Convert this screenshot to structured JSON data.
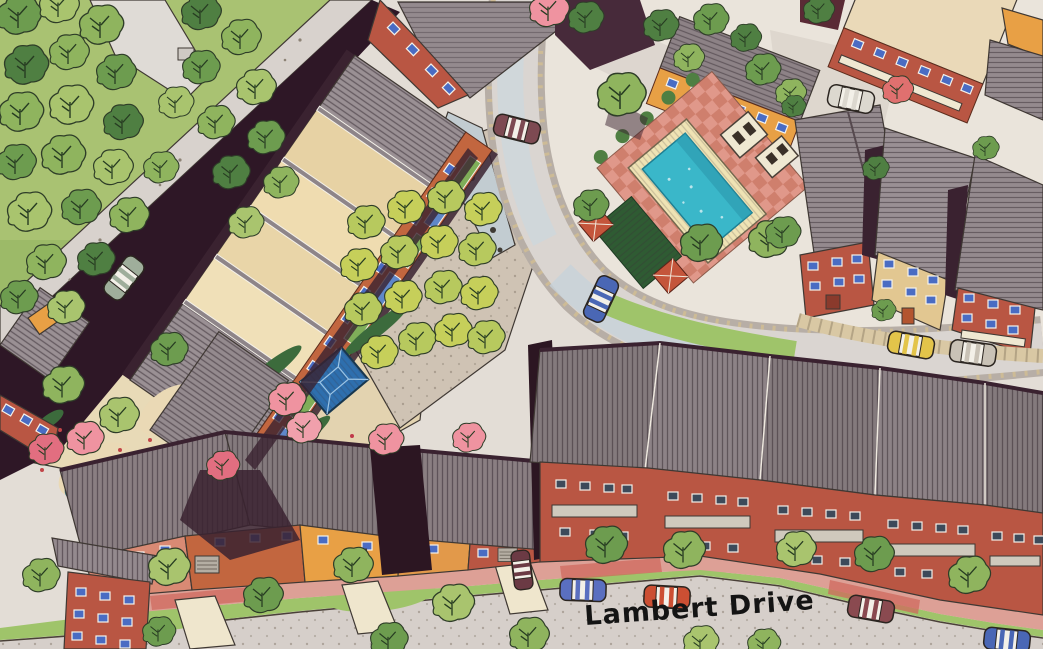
{
  "map": {
    "type": "illustrated-aerial-site-plan",
    "street_label": "Lambert Drive",
    "palette": {
      "paper": "#e3ddd6",
      "street_light": "#dad5d1",
      "street_blue_tint": "#c7d2da",
      "shaded_lane": "#2e1726",
      "roof_gray": "#948a8e",
      "roof_dark_townhouse": "#847a7d",
      "roof_tan_panels": "#ecd9ae",
      "roof_cream": "#ead9b8",
      "brick_facade": "#b95643",
      "orange_facade": "#e8a045",
      "tan_facade": "#e2c791",
      "window_blue": "#4a6cc3",
      "window_dark": "#3d4a5a",
      "pool_teal": "#3ab7c9",
      "pool_coping_cream": "#efe3b4",
      "plaza_brick_pink": "#e0988a",
      "sidewalk_pink": "#dda096",
      "path_red": "#cf6a5e",
      "grass": "#9fc46a",
      "woodland_ground": "#a9c272",
      "tree_green": "#8fb45e",
      "tree_dark_green": "#4f7f42",
      "tree_yellow_green": "#c6cf5a",
      "tree_pink": "#ef93a0",
      "hedge_dark": "#2f5b33",
      "gazebo_blue": "#2e6fae",
      "pond_blue": "#53aec7",
      "curb_stone": "#d9c8a4",
      "label_ink": "#141414"
    },
    "features": [
      {
        "name": "woodland",
        "type": "tree-grove",
        "location": "northwest"
      },
      {
        "name": "shaded-lane",
        "type": "road",
        "location": "northwest diagonal"
      },
      {
        "name": "long-building-tan-roof-panels",
        "type": "building",
        "location": "center-west"
      },
      {
        "name": "orchard-tree-rows",
        "type": "planting",
        "location": "center"
      },
      {
        "name": "central-courtyard-garden",
        "type": "garden",
        "location": "center"
      },
      {
        "name": "blue-roof-gazebo",
        "type": "pavilion",
        "location": "central courtyard"
      },
      {
        "name": "west-courtyard-garden-with-pond",
        "type": "garden",
        "location": "west"
      },
      {
        "name": "swimming-pool",
        "type": "pool",
        "location": "northeast plaza"
      },
      {
        "name": "pool-brick-plaza",
        "type": "paving",
        "location": "northeast"
      },
      {
        "name": "pergola-trellis",
        "type": "structure",
        "location": "west of pool"
      },
      {
        "name": "pool-side-pavilions",
        "type": "structure",
        "location": "east of pool"
      },
      {
        "name": "loop-road",
        "type": "road",
        "location": "around pool plaza"
      },
      {
        "name": "townhouse-row-sawtooth",
        "type": "housing-row",
        "location": "center-south"
      },
      {
        "name": "south-house-row",
        "type": "housing-row",
        "location": "southwest"
      },
      {
        "name": "east-condo-buildings",
        "type": "housing",
        "location": "east"
      },
      {
        "name": "north-buildings",
        "type": "buildings",
        "location": "north"
      },
      {
        "name": "lambert-drive",
        "type": "street",
        "label": "Lambert Drive",
        "location": "south"
      }
    ],
    "cars": [
      {
        "color": "sage-gray",
        "location": "shaded lane, northwest"
      },
      {
        "color": "maroon-white-roof",
        "location": "north parking bay"
      },
      {
        "color": "white",
        "location": "northeast courtyard"
      },
      {
        "color": "blue-white-roof",
        "location": "loop road by pool"
      },
      {
        "color": "yellow",
        "location": "east street below condos"
      },
      {
        "color": "gray-white-roof",
        "location": "east street below condos"
      },
      {
        "color": "blue-white-roof",
        "location": "Lambert Drive center"
      },
      {
        "color": "red-white-roof",
        "location": "Lambert Drive center"
      },
      {
        "color": "dark-maroon",
        "location": "driveway, south row"
      },
      {
        "color": "maroon-white-roof",
        "location": "Lambert Drive east"
      },
      {
        "color": "blue-white-roof",
        "location": "Lambert Drive southeast corner"
      }
    ]
  }
}
